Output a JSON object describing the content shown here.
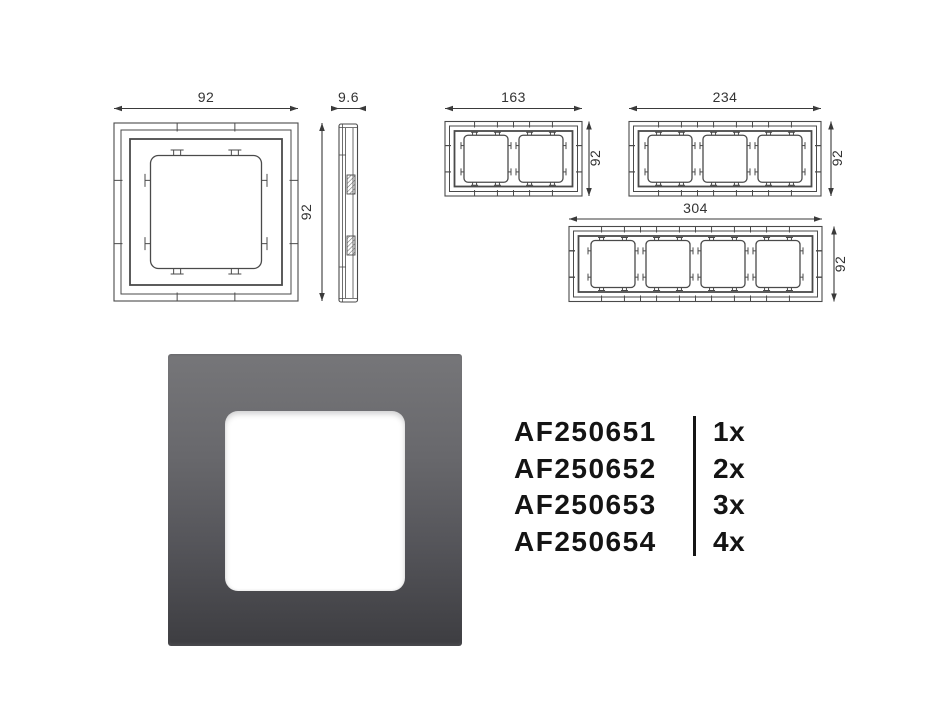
{
  "drawings": {
    "front_view": {
      "width_label": "92",
      "height_label": "92"
    },
    "side_view": {
      "depth_label": "9.6"
    },
    "frame_2gang": {
      "width_label": "163",
      "height_label": "92"
    },
    "frame_3gang": {
      "width_label": "234",
      "height_label": "92"
    },
    "frame_4gang": {
      "width_label": "304",
      "height_label": "92"
    }
  },
  "colors": {
    "line": "#4a4a4a",
    "dim_line": "#3a3a3a",
    "dim_text": "#333333",
    "photo_top": "#767679",
    "photo_bottom": "#3d3d41",
    "opening": "#ffffff",
    "part_text": "#141414"
  },
  "part_list": {
    "items": [
      {
        "sku": "AF250651",
        "qty": "1x"
      },
      {
        "sku": "AF250652",
        "qty": "2x"
      },
      {
        "sku": "AF250653",
        "qty": "3x"
      },
      {
        "sku": "AF250654",
        "qty": "4x"
      }
    ]
  }
}
